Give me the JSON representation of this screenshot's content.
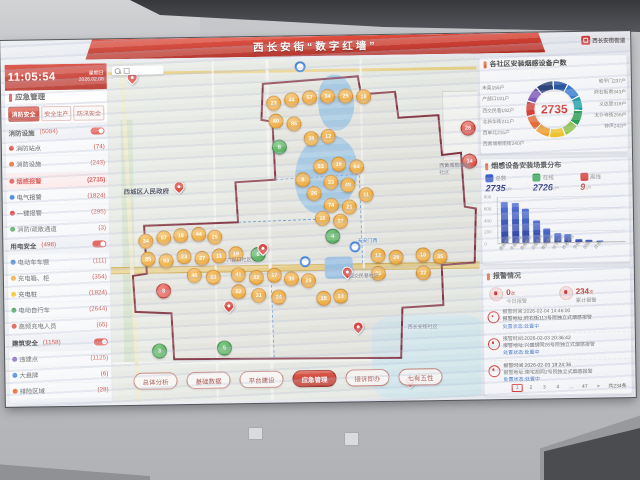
{
  "banner": {
    "title": "西长安街“数字红墙”",
    "corner_logo": "西长安街街道"
  },
  "clock": {
    "time": "11:05:54",
    "weekday": "星期日",
    "date": "2026.02.08"
  },
  "sidebar": {
    "header": "应急管理",
    "tabs": [
      {
        "t": "消防安全",
        "cls": "on"
      },
      {
        "t": "安全生产"
      },
      {
        "t": "防汛安全"
      }
    ],
    "rows": [
      {
        "cls": "grp",
        "label": "消防设施",
        "count": "(5084)"
      },
      {
        "cls": "it",
        "dc": "#d9342b",
        "label": "消防站点",
        "count": "(74)"
      },
      {
        "cls": "it",
        "dc": "#e8642c",
        "label": "消防设施",
        "count": "(243)"
      },
      {
        "cls": "it sel",
        "dc": "#d9342b",
        "label": "烟感报警",
        "count": "(2735)"
      },
      {
        "cls": "it",
        "dc": "#2f78d4",
        "label": "电气报警",
        "count": "(1824)"
      },
      {
        "cls": "it",
        "dc": "#d9342b",
        "label": "一键报警",
        "count": "(295)"
      },
      {
        "cls": "it",
        "dc": "#2f9e4b",
        "label": "消防/疏散通道",
        "count": "(3)"
      },
      {
        "cls": "grp",
        "label": "用电安全",
        "count": "(498)"
      },
      {
        "cls": "it",
        "dc": "#2f78d4",
        "label": "电动车车棚",
        "count": "(111)"
      },
      {
        "cls": "it",
        "dc": "#f59a1d",
        "label": "充电箱、柜",
        "count": "(354)"
      },
      {
        "cls": "it",
        "dc": "#f5c51d",
        "label": "充电桩",
        "count": "(1824)"
      },
      {
        "cls": "it",
        "dc": "#2f9e4b",
        "label": "电动自行车",
        "count": "(2644)"
      },
      {
        "cls": "it",
        "dc": "#d9342b",
        "label": "高频充电人员",
        "count": "(65)"
      },
      {
        "cls": "grp",
        "label": "建筑安全",
        "count": "(1158)"
      },
      {
        "cls": "it",
        "dc": "#7a4fb8",
        "label": "违建点",
        "count": "(1125)"
      },
      {
        "cls": "it",
        "dc": "#2f78d4",
        "label": "大悬牌",
        "count": "(6)"
      },
      {
        "cls": "it",
        "dc": "#e8642c",
        "label": "排险区域",
        "count": "(28)"
      },
      {
        "cls": "grp off",
        "label": "防汛事件",
        "count": "(34)"
      }
    ]
  },
  "map": {
    "labels": [
      {
        "t": "西城区人民政府",
        "x": 14,
        "y": 124,
        "cls": "gov"
      },
      {
        "t": "六部口社区",
        "x": 116,
        "y": 196
      },
      {
        "t": "西交民巷社区",
        "x": 238,
        "y": 214
      },
      {
        "t": "西黄城根南街社区",
        "x": 330,
        "y": 106,
        "cls": "vert"
      },
      {
        "t": "西长安街社区",
        "x": 296,
        "y": 266
      },
      {
        "t": "天安门西",
        "x": 247,
        "y": 179,
        "cls": "stn-lb"
      }
    ],
    "markers": [
      {
        "x": 158,
        "y": 36,
        "n": "23"
      },
      {
        "x": 176,
        "y": 33,
        "n": "44"
      },
      {
        "x": 194,
        "y": 31,
        "n": "57"
      },
      {
        "x": 212,
        "y": 30,
        "n": "34"
      },
      {
        "x": 230,
        "y": 30,
        "n": "25"
      },
      {
        "x": 248,
        "y": 31,
        "n": "18"
      },
      {
        "x": 160,
        "y": 54,
        "n": "40"
      },
      {
        "x": 178,
        "y": 57,
        "n": "85"
      },
      {
        "x": 195,
        "y": 72,
        "n": "38"
      },
      {
        "x": 212,
        "y": 70,
        "n": "12"
      },
      {
        "x": 204,
        "y": 100,
        "n": "53"
      },
      {
        "x": 222,
        "y": 98,
        "n": "19"
      },
      {
        "x": 240,
        "y": 101,
        "n": "64"
      },
      {
        "x": 214,
        "y": 116,
        "n": "33"
      },
      {
        "x": 231,
        "y": 119,
        "n": "48"
      },
      {
        "x": 197,
        "y": 127,
        "n": "26"
      },
      {
        "x": 214,
        "y": 139,
        "n": "74"
      },
      {
        "x": 232,
        "y": 141,
        "n": "21"
      },
      {
        "x": 249,
        "y": 129,
        "n": "11"
      },
      {
        "x": 186,
        "y": 113,
        "n": "9"
      },
      {
        "x": 205,
        "y": 152,
        "n": "16"
      },
      {
        "x": 223,
        "y": 155,
        "n": "27"
      },
      {
        "x": 28,
        "y": 172,
        "n": "34"
      },
      {
        "x": 46,
        "y": 169,
        "n": "57"
      },
      {
        "x": 63,
        "y": 167,
        "n": "18"
      },
      {
        "x": 81,
        "y": 166,
        "n": "44"
      },
      {
        "x": 97,
        "y": 169,
        "n": "25"
      },
      {
        "x": 30,
        "y": 190,
        "n": "85"
      },
      {
        "x": 48,
        "y": 192,
        "n": "93"
      },
      {
        "x": 66,
        "y": 188,
        "n": "23"
      },
      {
        "x": 84,
        "y": 190,
        "n": "27"
      },
      {
        "x": 101,
        "y": 188,
        "n": "11"
      },
      {
        "x": 118,
        "y": 186,
        "n": "16"
      },
      {
        "x": 76,
        "y": 207,
        "n": "46"
      },
      {
        "x": 95,
        "y": 209,
        "n": "63"
      },
      {
        "x": 120,
        "y": 207,
        "n": "41"
      },
      {
        "x": 138,
        "y": 210,
        "n": "22"
      },
      {
        "x": 156,
        "y": 208,
        "n": "17"
      },
      {
        "x": 173,
        "y": 212,
        "n": "35"
      },
      {
        "x": 190,
        "y": 214,
        "n": "29"
      },
      {
        "x": 120,
        "y": 224,
        "n": "52"
      },
      {
        "x": 140,
        "y": 228,
        "n": "31"
      },
      {
        "x": 160,
        "y": 230,
        "n": "24"
      },
      {
        "x": 205,
        "y": 232,
        "n": "15"
      },
      {
        "x": 222,
        "y": 230,
        "n": "13"
      },
      {
        "x": 260,
        "y": 190,
        "n": "12"
      },
      {
        "x": 278,
        "y": 192,
        "n": "29"
      },
      {
        "x": 305,
        "y": 190,
        "n": "18"
      },
      {
        "x": 322,
        "y": 192,
        "n": "35"
      },
      {
        "x": 260,
        "y": 208,
        "n": "31"
      },
      {
        "x": 305,
        "y": 208,
        "n": "22"
      },
      {
        "x": 163,
        "y": 80,
        "n": "8",
        "c": "g"
      },
      {
        "x": 140,
        "y": 187,
        "n": "6",
        "c": "g"
      },
      {
        "x": 105,
        "y": 280,
        "n": "5",
        "c": "g"
      },
      {
        "x": 40,
        "y": 282,
        "n": "3",
        "c": "g"
      },
      {
        "x": 215,
        "y": 170,
        "n": "4",
        "c": "g"
      },
      {
        "x": 352,
        "y": 64,
        "n": "26",
        "c": "r"
      },
      {
        "x": 353,
        "y": 97,
        "n": "14",
        "c": "r"
      },
      {
        "x": 45,
        "y": 222,
        "n": "8",
        "c": "r"
      }
    ],
    "pins": [
      {
        "x": 19,
        "y": 10
      },
      {
        "x": 64,
        "y": 120
      },
      {
        "x": 147,
        "y": 183
      },
      {
        "x": 231,
        "y": 208
      },
      {
        "x": 241,
        "y": 263
      },
      {
        "x": 112,
        "y": 240
      },
      {
        "x": 292,
        "y": 318
      }
    ],
    "stations": [
      {
        "x": 187,
        "y": 2
      },
      {
        "x": 189,
        "y": 197
      },
      {
        "x": 239,
        "y": 183
      }
    ]
  },
  "bottom_tabs": [
    {
      "t": "总体分析"
    },
    {
      "t": "基础数据"
    },
    {
      "t": "平台建设"
    },
    {
      "t": "应急管理",
      "active": true
    },
    {
      "t": "接诉即办"
    },
    {
      "t": "七有五性"
    }
  ],
  "panel_donut": {
    "title": "各社区安装烟感设备户数",
    "center": "2735",
    "left_labels": [
      {
        "t": "未英155户"
      },
      {
        "t": "户部口181户"
      },
      {
        "t": "西交民巷192户"
      },
      {
        "t": "北新华街211户"
      },
      {
        "t": "西单北215户"
      },
      {
        "t": "西黄城根南街240户"
      }
    ],
    "right_labels": [
      {
        "t": "和平门237户"
      },
      {
        "t": "府右街南343户"
      },
      {
        "t": "义达里319户"
      },
      {
        "t": "太仆寺街256户"
      },
      {
        "t": "钟声242户"
      }
    ],
    "chart_data": {
      "type": "pie",
      "title": "各社区安装烟感设备户数",
      "center_total": 2735,
      "segments": [
        {
          "name": "和平门",
          "value": 237
        },
        {
          "name": "府右街南",
          "value": 343
        },
        {
          "name": "义达里",
          "value": 319
        },
        {
          "name": "太仆寺街",
          "value": 256
        },
        {
          "name": "钟声",
          "value": 242
        },
        {
          "name": "西黄城根南街",
          "value": 240
        },
        {
          "name": "西单北",
          "value": 215
        },
        {
          "name": "北新华街",
          "value": 211
        },
        {
          "name": "西交民巷",
          "value": 192
        },
        {
          "name": "户部口",
          "value": 181
        },
        {
          "name": "未英",
          "value": 155
        }
      ]
    }
  },
  "panel_bars": {
    "title": "烟感设备安装场景分布",
    "stats": [
      {
        "label": "总数",
        "value": "2735",
        "unit": "/户",
        "color": "#2f54c9"
      },
      {
        "label": "在线",
        "value": "2726",
        "unit": "/户",
        "color": "#2fa84f"
      },
      {
        "label": "离线",
        "value": "9",
        "unit": "/户",
        "color": "#d9342b",
        "cls": "off"
      }
    ],
    "yticks": [
      {
        "t": "800"
      },
      {
        "t": "600"
      },
      {
        "t": "400"
      },
      {
        "t": "200"
      },
      {
        "t": "0"
      }
    ],
    "bars": [
      {
        "v": 720
      },
      {
        "v": 690
      },
      {
        "v": 600
      },
      {
        "v": 380
      },
      {
        "v": 240
      },
      {
        "v": 150
      },
      {
        "v": 140
      },
      {
        "v": 45
      },
      {
        "v": 30
      },
      {
        "v": 20
      }
    ],
    "xcats": [
      {
        "t": "居民楼院"
      },
      {
        "t": "平房院落"
      },
      {
        "t": "商务楼宇"
      },
      {
        "t": "沿街商户"
      },
      {
        "t": "餐饮场所"
      },
      {
        "t": "地下空间"
      },
      {
        "t": "养老机构"
      },
      {
        "t": "学校"
      },
      {
        "t": "医院"
      },
      {
        "t": "其他"
      }
    ],
    "chart_data": {
      "type": "bar",
      "title": "烟感设备安装场景分布",
      "categories": [
        "居民楼院",
        "平房院落",
        "商务楼宇",
        "沿街商户",
        "餐饮场所",
        "地下空间",
        "养老机构",
        "学校",
        "医院",
        "其他"
      ],
      "values": [
        720,
        690,
        600,
        380,
        240,
        150,
        140,
        45,
        30,
        20
      ],
      "ylim": [
        0,
        800
      ],
      "totals": {
        "总数": 2735,
        "在线": 2726,
        "离线": 9
      }
    }
  },
  "panel_alarms": {
    "title": "报警情况",
    "stats": [
      {
        "value": "0",
        "unit": "次",
        "label": "今日报警"
      },
      {
        "value": "234",
        "unit": "次",
        "label": "累计报警"
      }
    ],
    "items": [
      {
        "time": "报警时间:2026-02-04 14:46:00",
        "addr": "报警地址:府右街113号院独立式烟感报警",
        "status": "处置状态:处置中"
      },
      {
        "time": "报警时间:2026-02-03 20:36:42",
        "addr": "报警地址:兴盛胡同26号院独立式烟感报警",
        "status": "处置状态:处置中"
      },
      {
        "time": "报警时间:2026-02-03 18:24:36",
        "addr": "报警地址:南宅胡同2号院独立式烟感报警",
        "status": "处置状态:处置中"
      }
    ],
    "pagination": [
      {
        "t": "1",
        "cls": "cur"
      },
      {
        "t": "2"
      },
      {
        "t": "3"
      },
      {
        "t": "4"
      },
      {
        "t": "…"
      },
      {
        "t": "47"
      },
      {
        "t": ">"
      }
    ],
    "total": "共234条"
  }
}
